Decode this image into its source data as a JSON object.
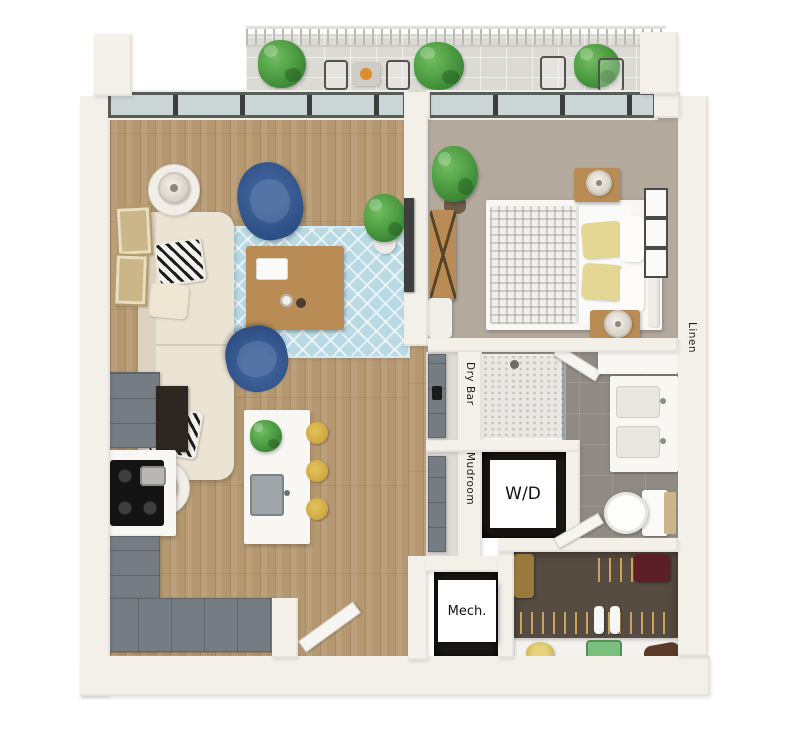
{
  "labels": {
    "dry_bar": "Dry Bar",
    "mudroom": "Mudroom",
    "wd": "W/D",
    "mech": "Mech.",
    "linen": "Linen"
  },
  "palette": {
    "wall": "#f3f0ea",
    "wood": "#b59870",
    "carpet_bed": "#b3a99d",
    "tile_bath": "#8f8a84",
    "shower_tile": "#e9e7e3",
    "carpet_closet": "#574c42",
    "balcony": "#dcdad5",
    "cabinet": "#767c84",
    "counter": "#f8f7f4",
    "sofa": "#ebe3d4",
    "chair": "#2e4f85",
    "rug": "#b9d9e5",
    "stool": "#cfa73f",
    "plant": "#47963d",
    "plant_dark": "#2f7030",
    "pillow_yellow": "#e4d693",
    "frame_tan": "#cbb68a",
    "glass": "#ccd5d6",
    "dark_room": "#201c18",
    "wood_table": "#b98c55",
    "label": "#1d1d1d"
  }
}
